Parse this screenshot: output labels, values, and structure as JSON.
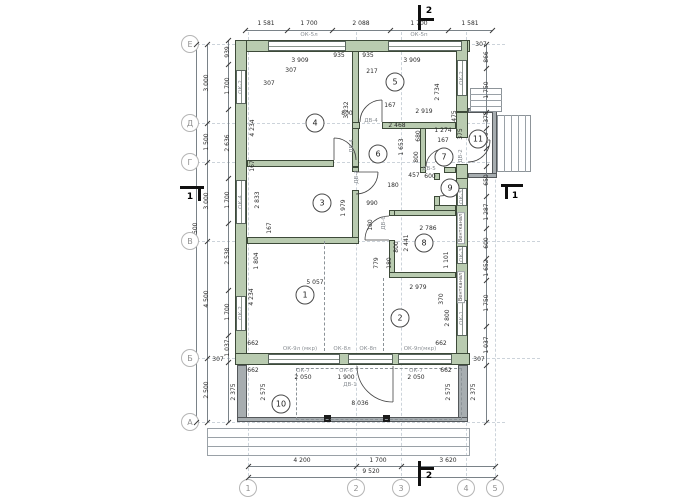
{
  "drawing": {
    "axis_rows": [
      {
        "label": "Е",
        "y": 44
      },
      {
        "label": "Д",
        "y": 123
      },
      {
        "label": "Г",
        "y": 162
      },
      {
        "label": "В",
        "y": 241
      },
      {
        "label": "Б",
        "y": 358
      },
      {
        "label": "А",
        "y": 422
      }
    ],
    "axis_cols": [
      {
        "label": "1",
        "x": 248
      },
      {
        "label": "2",
        "x": 356
      },
      {
        "label": "3",
        "x": 401
      },
      {
        "label": "4",
        "x": 466
      },
      {
        "label": "5",
        "x": 495
      }
    ],
    "rooms": [
      {
        "n": "1",
        "x": 305,
        "y": 295
      },
      {
        "n": "2",
        "x": 400,
        "y": 318
      },
      {
        "n": "3",
        "x": 322,
        "y": 203
      },
      {
        "n": "4",
        "x": 315,
        "y": 123
      },
      {
        "n": "5",
        "x": 395,
        "y": 82
      },
      {
        "n": "6",
        "x": 378,
        "y": 154
      },
      {
        "n": "7",
        "x": 444,
        "y": 157
      },
      {
        "n": "8",
        "x": 424,
        "y": 243
      },
      {
        "n": "9",
        "x": 450,
        "y": 188
      },
      {
        "n": "10",
        "x": 281,
        "y": 404
      },
      {
        "n": "11",
        "x": 478,
        "y": 139
      }
    ],
    "sections": [
      {
        "label": "2",
        "x": 429,
        "y": 11
      },
      {
        "label": "2",
        "x": 429,
        "y": 476
      },
      {
        "label": "1",
        "x": 190,
        "y": 197
      },
      {
        "label": "1",
        "x": 515,
        "y": 196
      }
    ],
    "labels": [
      {
        "t": "1 581",
        "x": 266,
        "y": 24
      },
      {
        "t": "1 700",
        "x": 309,
        "y": 24
      },
      {
        "t": "2 088",
        "x": 361,
        "y": 24
      },
      {
        "t": "1 700",
        "x": 419,
        "y": 24
      },
      {
        "t": "1 581",
        "x": 470,
        "y": 24
      },
      {
        "t": "ОК-5л",
        "x": 309,
        "y": 35,
        "cls": "g"
      },
      {
        "t": "ОК-5п",
        "x": 419,
        "y": 35,
        "cls": "g"
      },
      {
        "t": "307",
        "x": 481,
        "y": 45
      },
      {
        "t": "3 909",
        "x": 300,
        "y": 61
      },
      {
        "t": "935",
        "x": 339,
        "y": 56
      },
      {
        "t": "935",
        "x": 368,
        "y": 56
      },
      {
        "t": "3 909",
        "x": 412,
        "y": 61
      },
      {
        "t": "217",
        "x": 372,
        "y": 72
      },
      {
        "t": "307",
        "x": 291,
        "y": 71
      },
      {
        "t": "307",
        "x": 269,
        "y": 84
      },
      {
        "t": "4 234",
        "x": 253,
        "y": 128,
        "v": 1
      },
      {
        "t": "3 232",
        "x": 347,
        "y": 110,
        "v": 1
      },
      {
        "t": "2 734",
        "x": 438,
        "y": 92,
        "v": 1
      },
      {
        "t": "167",
        "x": 253,
        "y": 166,
        "v": 1
      },
      {
        "t": "800",
        "x": 347,
        "y": 114
      },
      {
        "t": "167",
        "x": 390,
        "y": 106
      },
      {
        "t": "2 919",
        "x": 424,
        "y": 112
      },
      {
        "t": "2 468",
        "x": 397,
        "y": 126
      },
      {
        "t": "1 274",
        "x": 443,
        "y": 131
      },
      {
        "t": "375",
        "x": 461,
        "y": 134,
        "v": 1
      },
      {
        "t": "475",
        "x": 455,
        "y": 116,
        "v": 1
      },
      {
        "t": "167",
        "x": 443,
        "y": 141
      },
      {
        "t": "ДВ-4",
        "x": 371,
        "y": 121,
        "cls": "g"
      },
      {
        "t": "ДВ-4",
        "x": 352,
        "y": 146,
        "v": 1,
        "cls": "g"
      },
      {
        "t": "1 653",
        "x": 402,
        "y": 147,
        "v": 1
      },
      {
        "t": "680",
        "x": 419,
        "y": 136,
        "v": 1
      },
      {
        "t": "800",
        "x": 417,
        "y": 157,
        "v": 1
      },
      {
        "t": "1 274",
        "x": 443,
        "y": 161
      },
      {
        "t": "457",
        "x": 414,
        "y": 176
      },
      {
        "t": "600",
        "x": 430,
        "y": 177
      },
      {
        "t": "180",
        "x": 393,
        "y": 186
      },
      {
        "t": "ДВ-5",
        "x": 429,
        "y": 169,
        "cls": "g"
      },
      {
        "t": "ДВ-2",
        "x": 461,
        "y": 156,
        "v": 1,
        "cls": "g"
      },
      {
        "t": "2 833",
        "x": 258,
        "y": 200,
        "v": 1
      },
      {
        "t": "1 979",
        "x": 344,
        "y": 208,
        "v": 1
      },
      {
        "t": "167",
        "x": 270,
        "y": 228,
        "v": 1
      },
      {
        "t": "990",
        "x": 372,
        "y": 204
      },
      {
        "t": "ДВ-3",
        "x": 357,
        "y": 177,
        "v": 1,
        "cls": "g"
      },
      {
        "t": "180",
        "x": 371,
        "y": 225,
        "v": 1
      },
      {
        "t": "2 786",
        "x": 428,
        "y": 229
      },
      {
        "t": "2 441",
        "x": 407,
        "y": 243,
        "v": 1
      },
      {
        "t": "800",
        "x": 397,
        "y": 247,
        "v": 1
      },
      {
        "t": "779",
        "x": 377,
        "y": 263,
        "v": 1
      },
      {
        "t": "180",
        "x": 390,
        "y": 263,
        "v": 1
      },
      {
        "t": "1 101",
        "x": 447,
        "y": 260,
        "v": 1
      },
      {
        "t": "2 979",
        "x": 418,
        "y": 288
      },
      {
        "t": "ДВ-6",
        "x": 384,
        "y": 223,
        "v": 1,
        "cls": "g"
      },
      {
        "t": "5 057",
        "x": 315,
        "y": 283
      },
      {
        "t": "4 234",
        "x": 252,
        "y": 297,
        "v": 1
      },
      {
        "t": "1 804",
        "x": 257,
        "y": 261,
        "v": 1
      },
      {
        "t": "370",
        "x": 442,
        "y": 299,
        "v": 1
      },
      {
        "t": "2 800",
        "x": 448,
        "y": 318,
        "v": 1
      },
      {
        "t": "662",
        "x": 253,
        "y": 344
      },
      {
        "t": "662",
        "x": 441,
        "y": 344
      },
      {
        "t": "ОК-9л (мкр)",
        "x": 300,
        "y": 349,
        "cls": "g"
      },
      {
        "t": "ОК-8л",
        "x": 342,
        "y": 349,
        "cls": "g"
      },
      {
        "t": "ОК-8п",
        "x": 368,
        "y": 349,
        "cls": "g"
      },
      {
        "t": "ОК-9п(мкр)",
        "x": 420,
        "y": 349,
        "cls": "g"
      },
      {
        "t": "307",
        "x": 218,
        "y": 360
      },
      {
        "t": "307",
        "x": 479,
        "y": 360
      },
      {
        "t": "ОК-7",
        "x": 303,
        "y": 371,
        "cls": "g"
      },
      {
        "t": "2 050",
        "x": 303,
        "y": 378
      },
      {
        "t": "ОК-6",
        "x": 346,
        "y": 371,
        "cls": "g"
      },
      {
        "t": "1 900",
        "x": 346,
        "y": 378
      },
      {
        "t": "ДВ-1",
        "x": 350,
        "y": 385,
        "cls": "g"
      },
      {
        "t": "ОК-7",
        "x": 416,
        "y": 371,
        "cls": "g"
      },
      {
        "t": "2 050",
        "x": 416,
        "y": 378
      },
      {
        "t": "662",
        "x": 253,
        "y": 371
      },
      {
        "t": "662",
        "x": 446,
        "y": 371
      },
      {
        "t": "2 375",
        "x": 234,
        "y": 392,
        "v": 1
      },
      {
        "t": "2 575",
        "x": 264,
        "y": 392,
        "v": 1
      },
      {
        "t": "2 575",
        "x": 449,
        "y": 392,
        "v": 1
      },
      {
        "t": "2 375",
        "x": 474,
        "y": 392,
        "v": 1
      },
      {
        "t": "8 036",
        "x": 360,
        "y": 404
      },
      {
        "t": "939",
        "x": 228,
        "y": 52,
        "v": 1
      },
      {
        "t": "1 700",
        "x": 228,
        "y": 86,
        "v": 1
      },
      {
        "t": "2 636",
        "x": 228,
        "y": 143,
        "v": 1
      },
      {
        "t": "1 700",
        "x": 228,
        "y": 200,
        "v": 1
      },
      {
        "t": "2 538",
        "x": 228,
        "y": 256,
        "v": 1
      },
      {
        "t": "1 700",
        "x": 228,
        "y": 312,
        "v": 1
      },
      {
        "t": "1 037",
        "x": 228,
        "y": 348,
        "v": 1
      },
      {
        "t": "3 000",
        "x": 207,
        "y": 83,
        "v": 1
      },
      {
        "t": "1 500",
        "x": 207,
        "y": 142,
        "v": 1
      },
      {
        "t": "3 000",
        "x": 207,
        "y": 201,
        "v": 1
      },
      {
        "t": "4 500",
        "x": 207,
        "y": 299,
        "v": 1
      },
      {
        "t": "2 500",
        "x": 207,
        "y": 390,
        "v": 1
      },
      {
        "t": "14 500",
        "x": 196,
        "y": 233,
        "v": 1
      },
      {
        "t": "ОК-2",
        "x": 241,
        "y": 87,
        "v": 1,
        "cls": "g"
      },
      {
        "t": "ОК-4",
        "x": 241,
        "y": 202,
        "v": 1,
        "cls": "g"
      },
      {
        "t": "ОК-2",
        "x": 241,
        "y": 313,
        "v": 1,
        "cls": "g"
      },
      {
        "t": "ОК-2",
        "x": 462,
        "y": 78,
        "v": 1,
        "cls": "g"
      },
      {
        "t": "ОК-3",
        "x": 462,
        "y": 197,
        "v": 1,
        "cls": "g"
      },
      {
        "t": "ОК-3",
        "x": 462,
        "y": 255,
        "v": 1,
        "cls": "g"
      },
      {
        "t": "ОК-1",
        "x": 462,
        "y": 318,
        "v": 1,
        "cls": "g"
      },
      {
        "t": "Вентканал",
        "x": 461,
        "y": 228,
        "v": 1,
        "cls": "vent"
      },
      {
        "t": "Вентканал",
        "x": 461,
        "y": 287,
        "v": 1,
        "cls": "vent"
      },
      {
        "t": "866",
        "x": 487,
        "y": 57,
        "v": 1
      },
      {
        "t": "1 750",
        "x": 487,
        "y": 90,
        "v": 1
      },
      {
        "t": "375",
        "x": 487,
        "y": 117,
        "v": 1
      },
      {
        "t": "900",
        "x": 487,
        "y": 138,
        "v": 1
      },
      {
        "t": "650",
        "x": 487,
        "y": 180,
        "v": 1
      },
      {
        "t": "1 287",
        "x": 487,
        "y": 212,
        "v": 1
      },
      {
        "t": "600",
        "x": 487,
        "y": 243,
        "v": 1
      },
      {
        "t": "1 652",
        "x": 487,
        "y": 268,
        "v": 1
      },
      {
        "t": "1 750",
        "x": 487,
        "y": 303,
        "v": 1
      },
      {
        "t": "1 037",
        "x": 487,
        "y": 345,
        "v": 1
      },
      {
        "t": "4 200",
        "x": 302,
        "y": 461
      },
      {
        "t": "1 700",
        "x": 378,
        "y": 461
      },
      {
        "t": "3 620",
        "x": 448,
        "y": 461
      },
      {
        "t": "9 520",
        "x": 371,
        "y": 472
      }
    ]
  }
}
